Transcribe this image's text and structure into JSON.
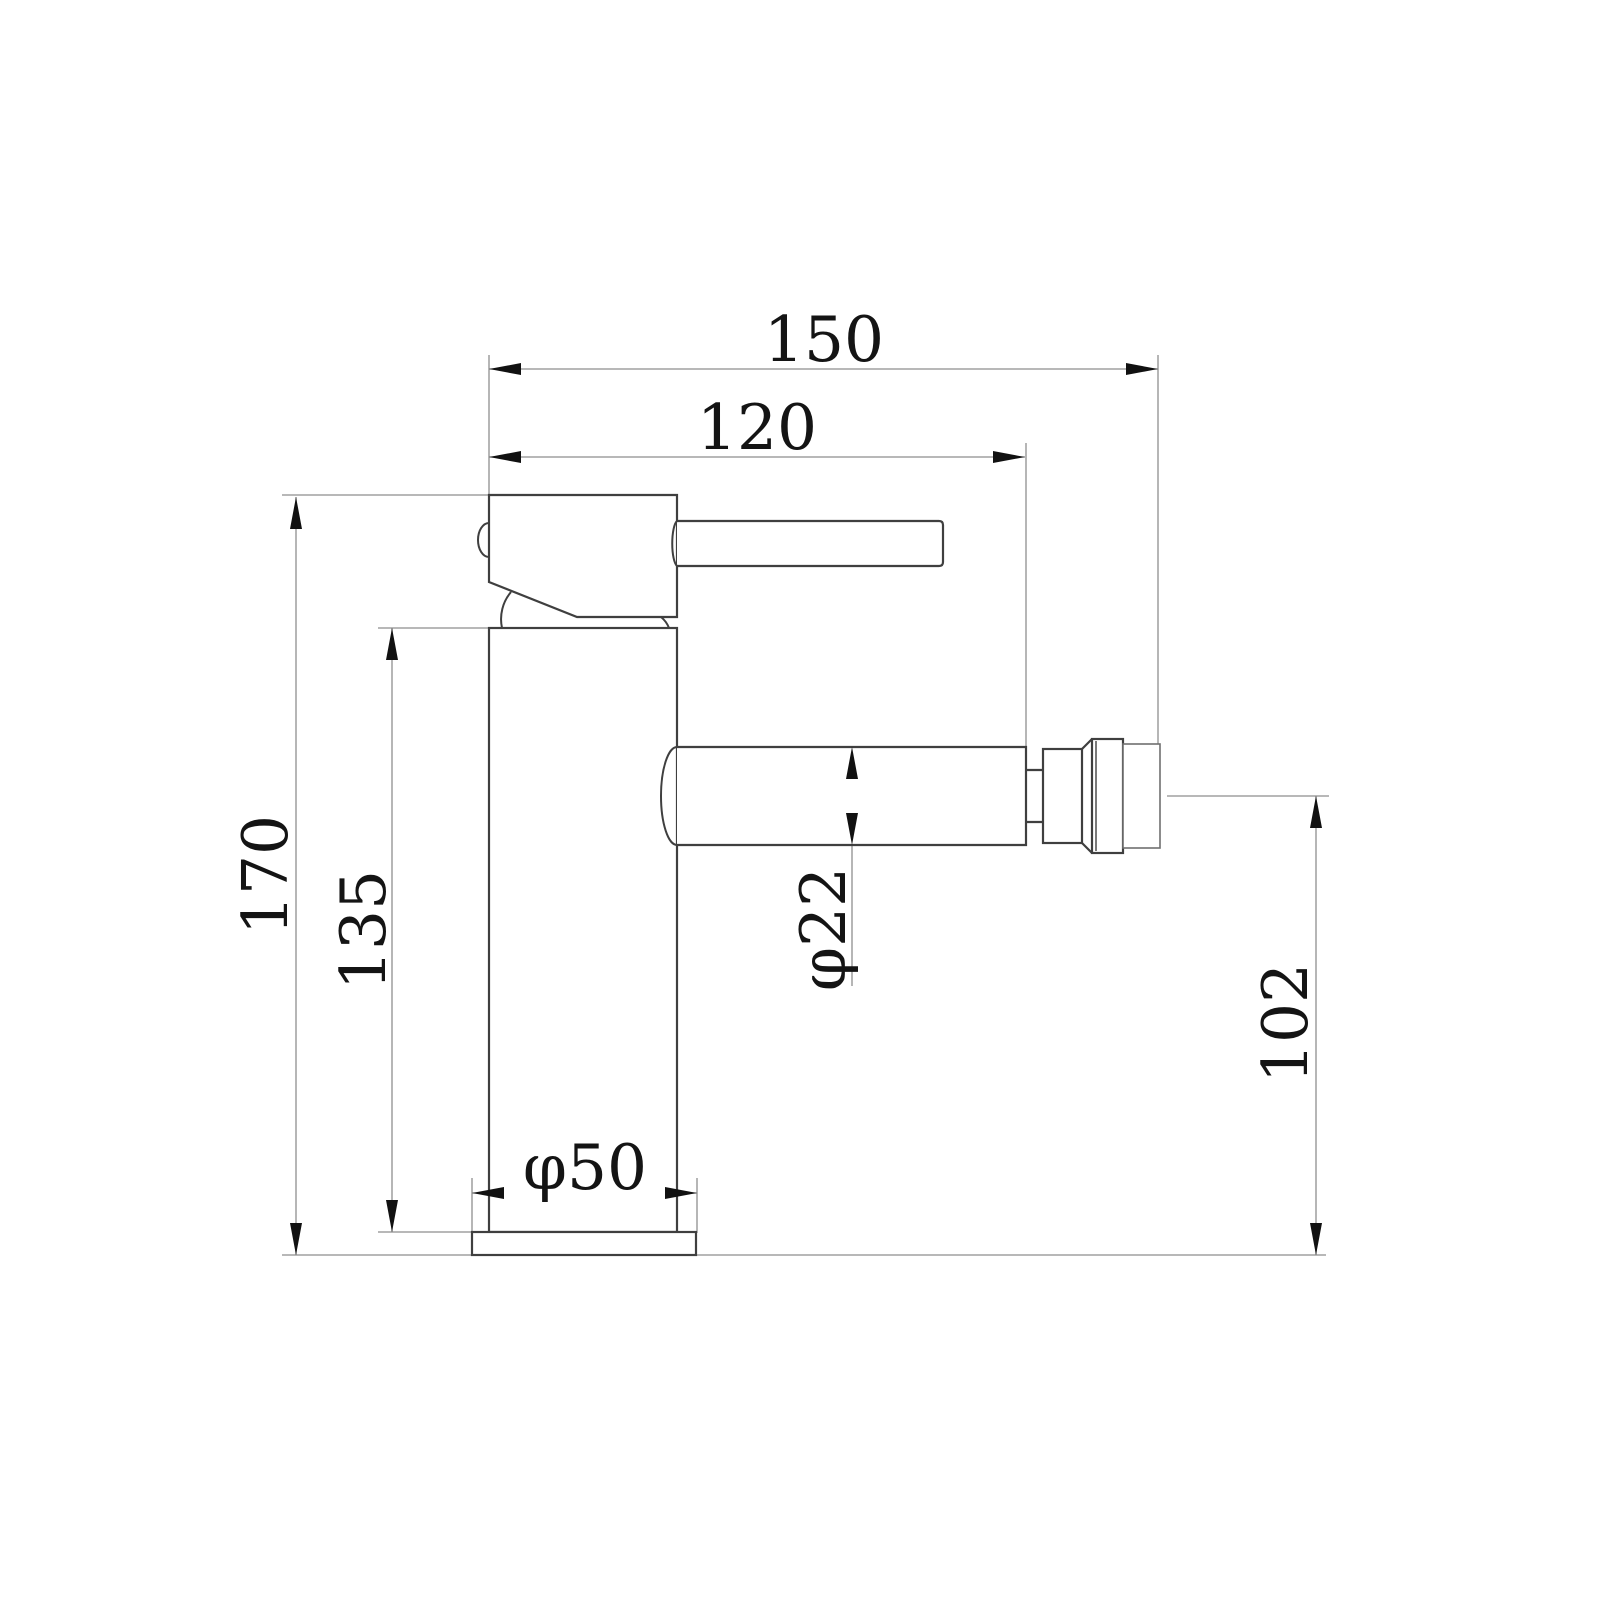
{
  "colors": {
    "background": "#ffffff",
    "object_outline": "#3f3f3f",
    "thin_line": "#8e8e8e",
    "annotation": "#141414"
  },
  "dimensions": {
    "total_width": "150",
    "spout_reach": "120",
    "total_height": "170",
    "column_height": "135",
    "spout_diameter": "φ22",
    "base_diameter": "φ50",
    "spout_center_height": "102"
  }
}
